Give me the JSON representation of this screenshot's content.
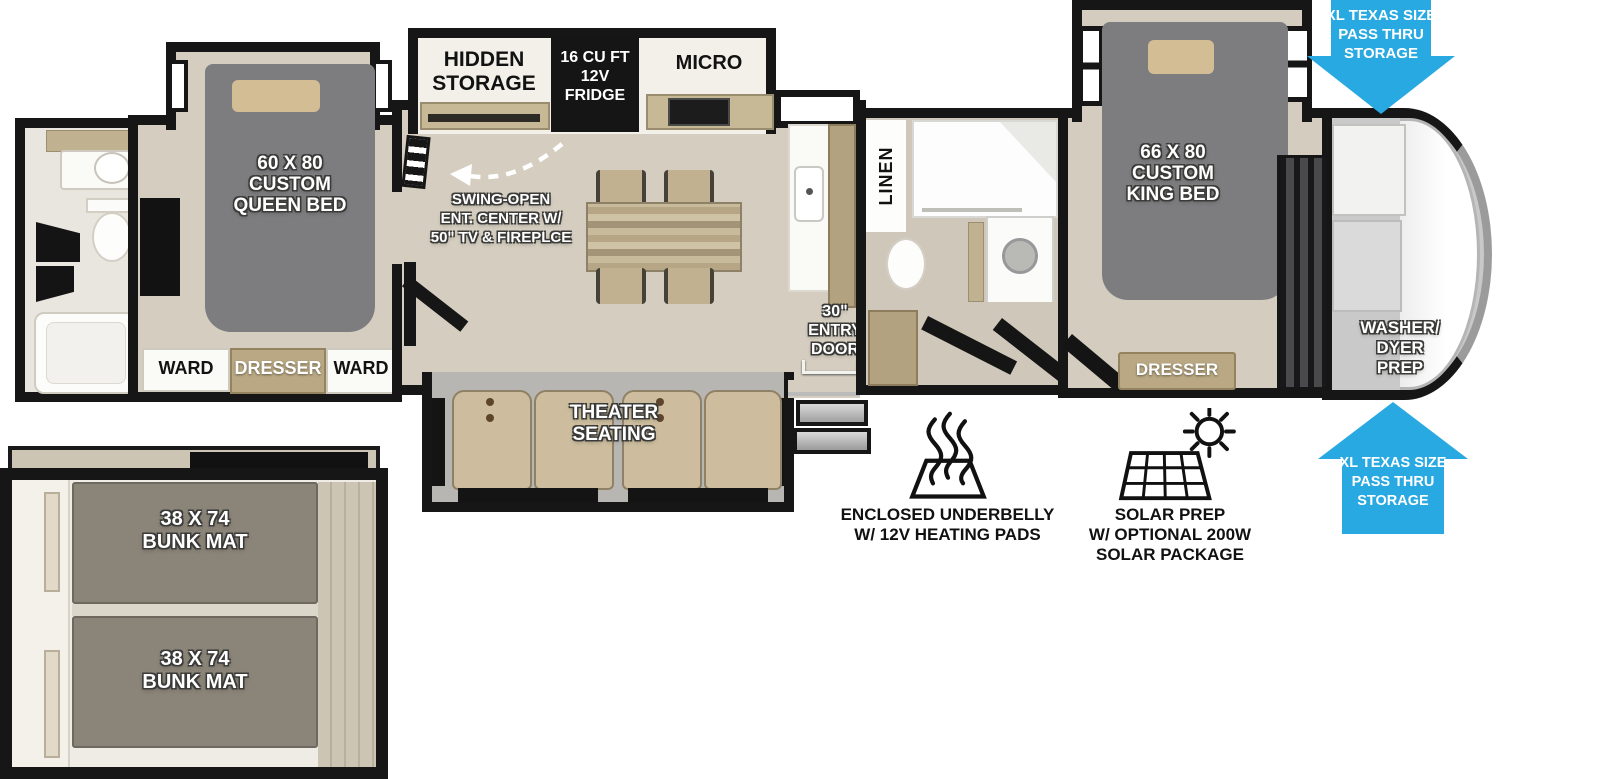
{
  "title": "Fifth Wheel RV Floorplan",
  "colors": {
    "accent_blue": "#29a9e2",
    "wall_black": "#161616",
    "floor_tan": "#d5cec0",
    "bed_gray": "#7d7d7f",
    "counter_tan": "#c1b190",
    "seat_tan": "#cdbd9e",
    "bunk_mat_gray": "#8b8478"
  },
  "queen_bedroom": {
    "bed_label": [
      "60 X 80",
      "CUSTOM",
      "QUEEN BED"
    ],
    "ward_left": "WARD",
    "dresser": "DRESSER",
    "ward_right": "WARD"
  },
  "kitchen": {
    "hidden_storage": [
      "HIDDEN",
      "STORAGE"
    ],
    "fridge": [
      "16 CU FT",
      "12V",
      "FRIDGE"
    ],
    "micro": "MICRO",
    "swing_open_note": [
      "SWING-OPEN",
      "ENT. CENTER W/",
      "50\" TV & FIREPLCE"
    ]
  },
  "living": {
    "theater_seating": [
      "THEATER",
      "SEATING"
    ],
    "entry_door": [
      "30\"",
      "ENTRY",
      "DOOR"
    ]
  },
  "mid_bathroom": {
    "linen": "LINEN"
  },
  "king_bedroom": {
    "bed_label": [
      "66 X 80",
      "CUSTOM",
      "KING BED"
    ],
    "dresser": "DRESSER"
  },
  "front_cap": {
    "washer_dryer": [
      "WASHER/",
      "DYER",
      "PREP"
    ]
  },
  "storage_arrows": {
    "top": [
      "XL TEXAS SIZE",
      "PASS THRU",
      "STORAGE"
    ],
    "bottom": [
      "XL TEXAS SIZE",
      "PASS THRU",
      "STORAGE"
    ]
  },
  "bunk_room": {
    "top_mat": [
      "38 X 74",
      "BUNK MAT"
    ],
    "bottom_mat": [
      "38 X 74",
      "BUNK MAT"
    ]
  },
  "features": {
    "underbelly": [
      "ENCLOSED UNDERBELLY",
      "W/ 12V HEATING PADS"
    ],
    "solar": [
      "SOLAR PREP",
      "W/ OPTIONAL 200W",
      "SOLAR PACKAGE"
    ]
  }
}
